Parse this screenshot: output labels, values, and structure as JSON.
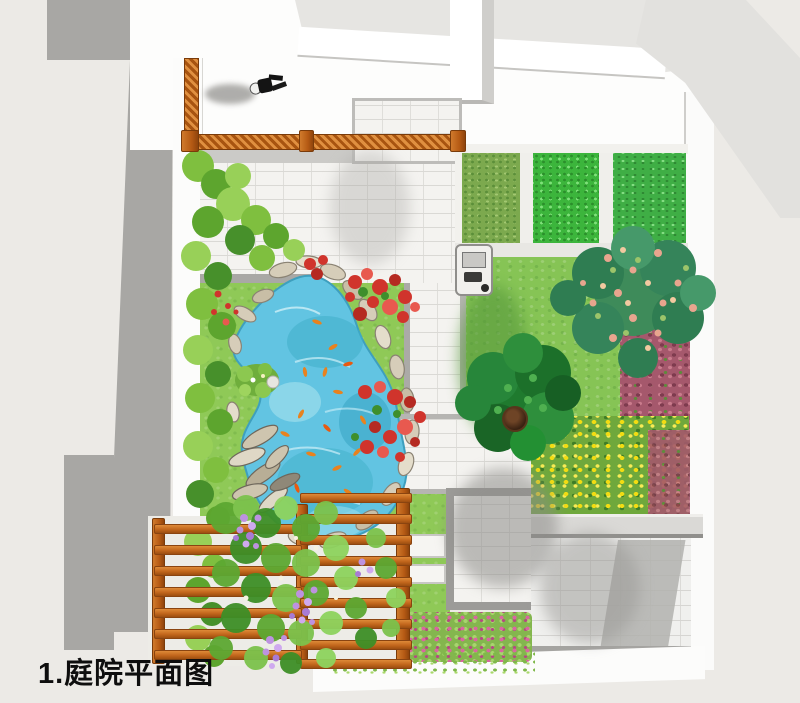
{
  "caption": "1.庭院平面图",
  "palette": {
    "background": "#ECEAE6",
    "building_shadow_gray": "#A8A7A4",
    "wall_white": "#FFFFFF",
    "paving_tile": "#F4F3F0",
    "paving_grout": "#DAD9D5",
    "lawn_green": "#86C455",
    "vegetable_plot_olive": "#7CA94E",
    "vegetable_plot_bright": "#3CB53C",
    "pond_blue": "#62C4E2",
    "pond_deep": "#3FAFC8",
    "koi_orange": "#E8821E",
    "rock_tan": "#D6CDB9",
    "wood_orange": "#C2661C",
    "flower_red": "#D0342C",
    "flower_purple": "#BD92E0",
    "flower_pink": "#D867A0",
    "flower_yellow": "#F2DC12",
    "groundcover_magenta": "#A5586C",
    "tree_dark_green": "#1F7A2E",
    "tree_mixed_green": "#3E8B5A"
  },
  "features": {
    "plan_type": "courtyard-landscape-plan",
    "elements": [
      "koi-pond",
      "rock-edging",
      "lily-island",
      "bamboo-hedge",
      "wood-pergola",
      "climbing-vines",
      "vegetable-plots",
      "lawn",
      "stone-paths",
      "patio",
      "garden-wall",
      "flower-beds",
      "round-tree",
      "mixed-tree",
      "balcony-railing",
      "person-figure",
      "fire-pot",
      "grill-cart"
    ]
  }
}
